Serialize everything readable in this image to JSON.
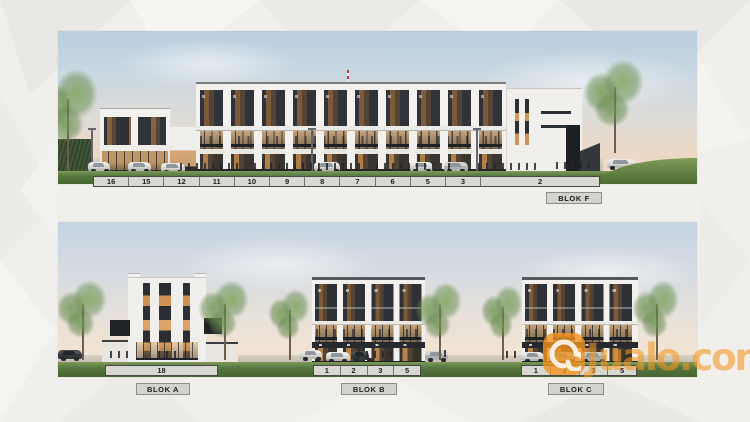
{
  "top_panel": {
    "name": "Blok F street elevation",
    "block_label": "BLOK F",
    "strip_units": [
      "16",
      "15",
      "12",
      "11",
      "10",
      "9",
      "8",
      "7",
      "6",
      "5",
      "3",
      "2"
    ]
  },
  "bottom_panel": {
    "name": "Blok A, B, C elevations",
    "blocks": [
      {
        "label": "BLOK A",
        "strip_units": [
          "18"
        ]
      },
      {
        "label": "BLOK B",
        "strip_units": [
          "1",
          "2",
          "3",
          "5"
        ]
      },
      {
        "label": "BLOK C",
        "strip_units": [
          "1",
          "2",
          "3",
          "5"
        ]
      }
    ]
  },
  "watermark": {
    "text": "Jualo.com",
    "logo_icon": "jualo-swirl-icon",
    "color": "#F2941E"
  },
  "colors": {
    "watermark_orange": "#F2941E",
    "strip_background": "#D8D8D3",
    "label_background": "#D3D3CE",
    "grass_green": "#567640",
    "sky_blue": "#C6D4E2",
    "facade_white": "#F1EFEB",
    "window_dark": "#2E3237"
  }
}
